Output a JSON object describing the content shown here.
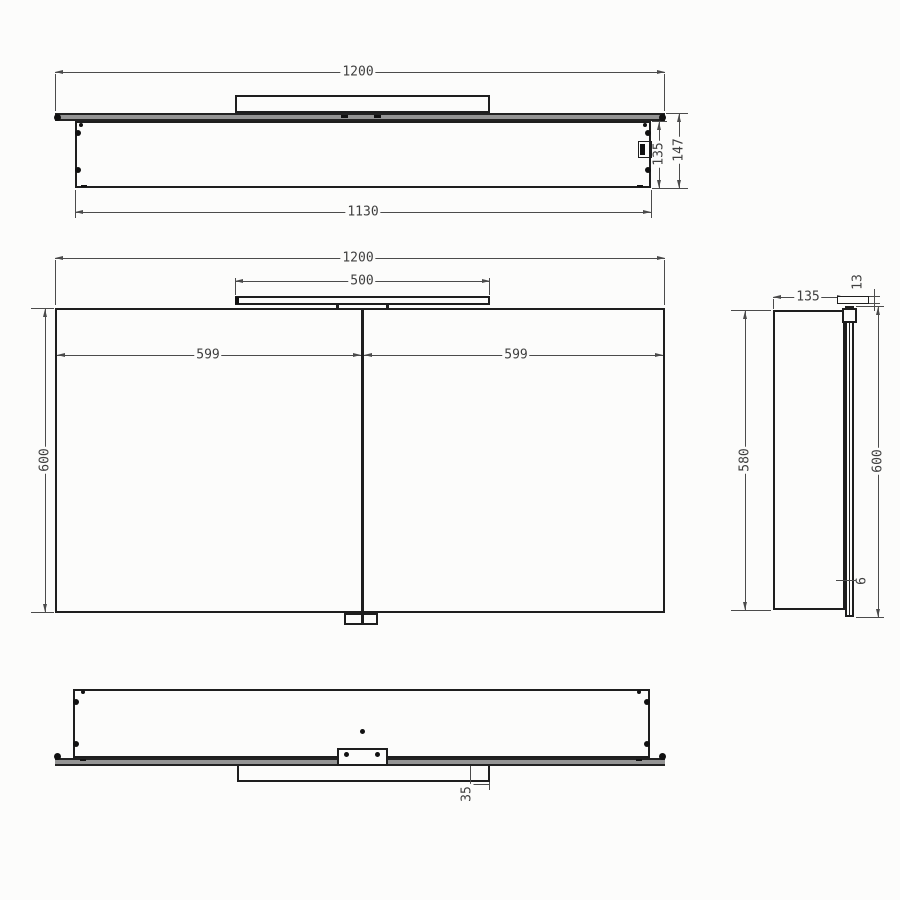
{
  "drawing_title": "Mirror cabinet dimension drawing",
  "colors": {
    "background": "#fcfcfb",
    "object_line": "#1e1e1e",
    "dimension_line": "#4b4b4b",
    "text": "#3f3f3f",
    "mirror_strip_fill": "#949494"
  },
  "views": {
    "top": {
      "dim_total_width": "1200",
      "dim_inner_width": "1130",
      "dim_body_depth": "135",
      "dim_total_depth": "147"
    },
    "front": {
      "dim_total_width": "1200",
      "dim_light_width": "500",
      "dim_left_door_width": "599",
      "dim_right_door_width": "599",
      "dim_height": "600"
    },
    "side": {
      "dim_depth": "135",
      "dim_light_thickness": "13",
      "dim_body_height": "580",
      "dim_door_height": "600",
      "dim_glass_thickness": "6"
    },
    "bottom": {
      "dim_light_inset": "35"
    }
  }
}
